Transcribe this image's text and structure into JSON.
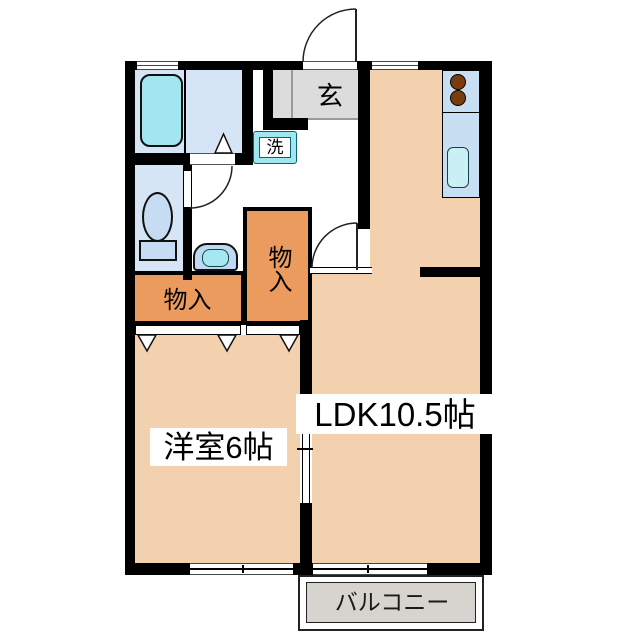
{
  "labels": {
    "entrance": "玄",
    "laundry": "洗",
    "closet_hall": "物入",
    "closet_side": "物入",
    "western_room": "洋室6帖",
    "ldk": "LDK10.5帖",
    "balcony": "バルコニー"
  },
  "colors": {
    "wall": "#000000",
    "room_floor": "#f3d0ae",
    "closet_fill": "#eb9b5e",
    "wet_area_floor": "#d6e5f6",
    "kitchen_counter": "#c8def2",
    "bathtub": "#a2e6f0",
    "kitchen_sink": "#c9f0f3",
    "laundry_box": "#9fe6f0",
    "entrance_floor": "#dcdcdc",
    "balcony_floor": "#d7d3cf",
    "stove_burner": "#7b3d10",
    "toilet_fixture": "#c5dcf3"
  }
}
